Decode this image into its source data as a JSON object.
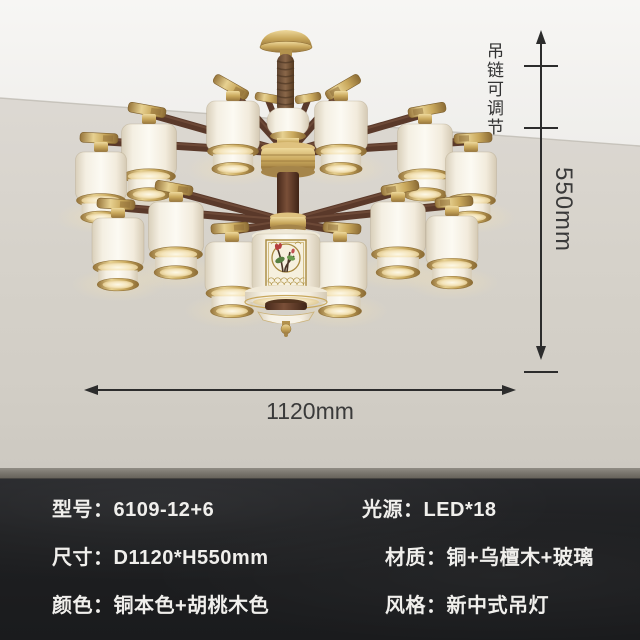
{
  "annotations": {
    "chain_note": "吊链可调节",
    "height_label": "550mm",
    "width_label": "1120mm"
  },
  "specs": {
    "rows": [
      {
        "left": "型号：6109-12+6",
        "right": "光源：LED*18"
      },
      {
        "left": "尺寸：D1120*H550mm",
        "right": "材质：铜+乌檀木+玻璃"
      },
      {
        "left": "颜色：铜本色+胡桃木色",
        "right": "风格：新中式吊灯"
      }
    ]
  },
  "colors": {
    "brass": "#c9a85c",
    "walnut_wood": "#5a392a",
    "glass_shade": "#f8f4ea",
    "wall": "#d5d1c9",
    "ceiling": "#f6f5f2",
    "spec_background": "#1d1e20",
    "spec_text": "#f0efec",
    "dimension_line": "#2c2c2c"
  }
}
